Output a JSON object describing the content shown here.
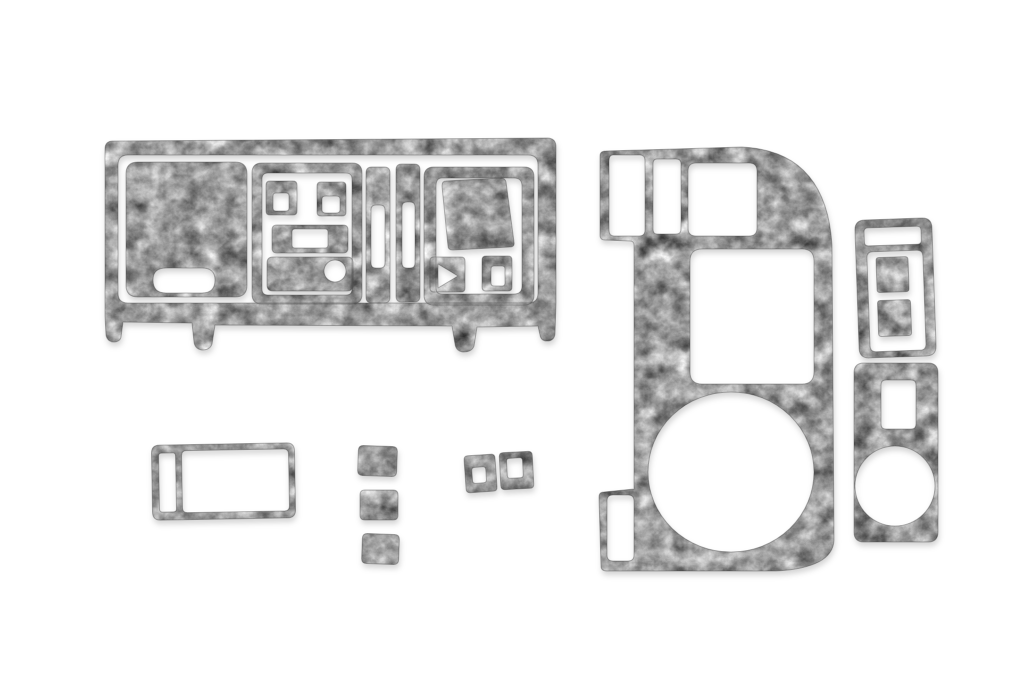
{
  "scene": {
    "title": "Grey burl dash trim kit product photo",
    "description": "Twelve-piece grey burl wood interior dash trim kit pieces arranged on a plain white background",
    "finish_name": "grey burl",
    "piece_count": "12"
  },
  "colors": {
    "background": "#ffffff",
    "texture_light": "#e9e9e9",
    "texture_mid": "#9e9e9e",
    "texture_dark": "#4f4f4f",
    "edge_line": "rgba(55,55,55,0.55)",
    "shadow": "rgba(0,0,0,0.18)"
  },
  "pieces": [
    {
      "id": "dash-main-panel",
      "name": "main dashboard fascia panel",
      "description": "wide panel with cluster block, switch sub-frame, two vent slot strips, shifter sub-frame and four mounting legs"
    },
    {
      "id": "console-side-panel",
      "name": "center console side panel",
      "description": "D-shaped panel with three vent openings on top, large square opening, round gauge opening and lower slot foot"
    },
    {
      "id": "switch-frame",
      "name": "switch panel frame",
      "description": "vertical frame with top slot opening and large opening"
    },
    {
      "id": "switch-insert-upper",
      "name": "upper switch insert",
      "description": "small solid rectangle inside switch frame"
    },
    {
      "id": "switch-insert-lower",
      "name": "lower switch insert",
      "description": "small solid rectangle inside switch frame"
    },
    {
      "id": "cupholder-panel",
      "name": "cup holder panel",
      "description": "tall panel with rectangular opening and large circular opening"
    },
    {
      "id": "glovebox-frame",
      "name": "glovebox trim frame",
      "description": "rectangular frame with narrow side slot and large opening"
    },
    {
      "id": "square-trim-1",
      "name": "square button trim 1",
      "description": "small solid square overlay"
    },
    {
      "id": "square-trim-2",
      "name": "square button trim 2",
      "description": "small solid square overlay"
    },
    {
      "id": "square-trim-3",
      "name": "square button trim 3",
      "description": "small solid square overlay"
    },
    {
      "id": "bezel-square-hole",
      "name": "small bezel with square hole",
      "description": "small square bezel with square cutout"
    },
    {
      "id": "bezel-slot-hole",
      "name": "small bezel with slot hole",
      "description": "small square bezel with vertical slot cutout"
    }
  ]
}
